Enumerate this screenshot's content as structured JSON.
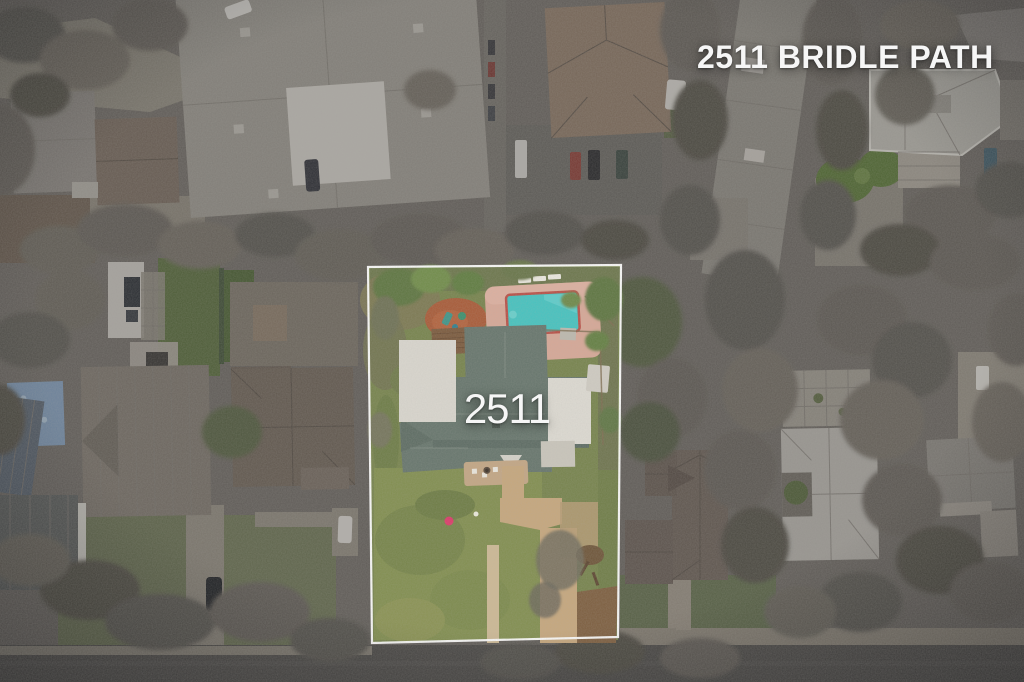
{
  "overlay": {
    "listing_address": "2511 BRIDLE PATH",
    "roof_house_number": "2511"
  },
  "palette": {
    "text": "#f6f6f6",
    "boundary": "#ffffff",
    "vignette": "rgba(28,30,34,0.18)",
    "base_ground": "#6f6b64",
    "asphalt_road": "#53514d",
    "lawn": "#76834c",
    "front_lawn": "#818e4f",
    "driveway": "#c6a77d",
    "pool_water": "#45c3c0",
    "pool_coping": "#b94f46",
    "pool_deck": "#d7a897",
    "hot_tub": "#90c9c3",
    "terracotta": "#a85a37",
    "wood_deck": "#7b5a3d",
    "shingle_roof": "#66756c",
    "flat_roof": "#dad7cf",
    "red_ball": "#dc3a69"
  }
}
